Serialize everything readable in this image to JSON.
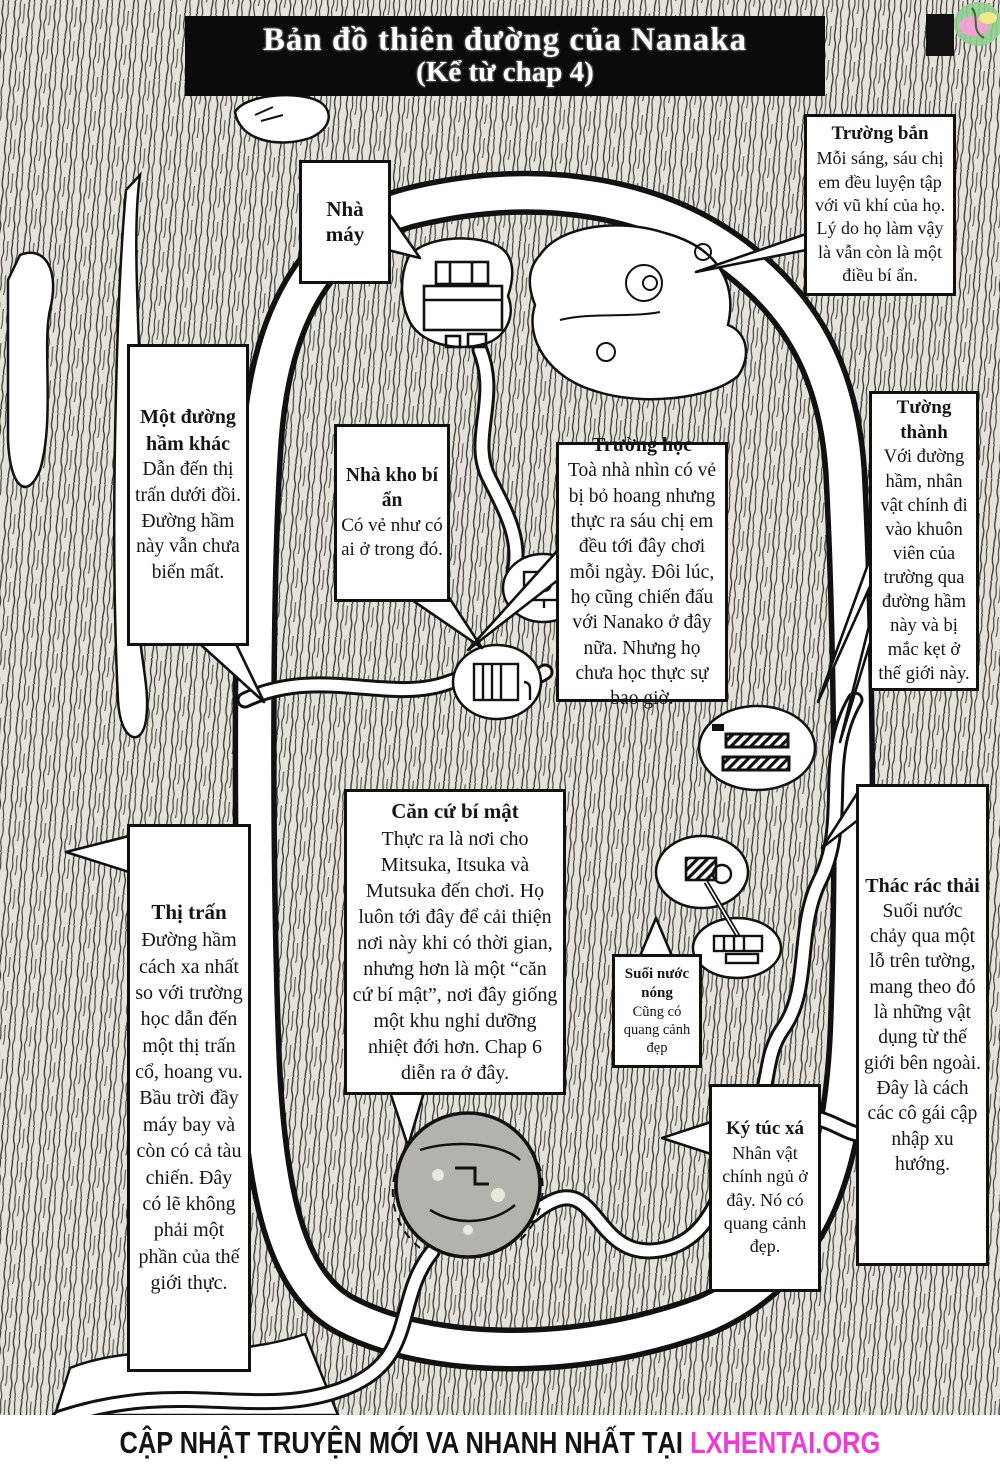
{
  "page": {
    "title_line1": "Bản đồ thiên đường của Nanaka",
    "title_line2": "(Kể từ chap 4)"
  },
  "boxes": {
    "nha_may": {
      "title": "Nhà máy"
    },
    "truong_ban": {
      "title": "Trường bắn",
      "body": "Mỗi sáng, sáu chị em đều luyện tập với vũ khí của họ. Lý do họ làm vậy là vẫn còn là một điều bí ẩn."
    },
    "duong_ham": {
      "title": "Một đường hầm khác",
      "body": "Dẫn đến thị trấn dưới đồi. Đường hầm này vẫn chưa biến mất."
    },
    "nha_kho": {
      "title": "Nhà kho bí ẩn",
      "body": "Có vẻ như có ai ở trong đó."
    },
    "truong_hoc": {
      "title": "Trường học",
      "body": "Toà nhà nhìn có vẻ bị bỏ hoang nhưng thực ra sáu chị em đều tới đây chơi mỗi ngày. Đôi lúc, họ cũng chiến đấu với Nanako ở đây nữa. Nhưng họ chưa học thực sự bao giờ."
    },
    "tuong_thanh": {
      "title": "Tường thành",
      "body": "Với đường hầm, nhân vật chính đi vào khuôn viên của trường qua đường hầm này và bị mắc kẹt ở thế giới này."
    },
    "thi_tran": {
      "title": "Thị trấn",
      "body": "Đường hầm cách xa nhất so với trường học dẫn đến một thị trấn cổ, hoang vu. Bầu trời đầy máy bay và còn có cả tàu chiến. Đây có lẽ không phải một phần của thế giới thực."
    },
    "can_cu": {
      "title": "Căn cứ bí mật",
      "body": "Thực ra là nơi cho Mitsuka, Itsuka và Mutsuka đến chơi. Họ luôn tới đây để cải thiện nơi này khi có thời gian, nhưng hơn là một “căn cứ bí mật”, nơi đây giống một khu nghỉ dưỡng nhiệt đới hơn. Chap 6 diễn ra ở đây."
    },
    "suoi": {
      "title": "Suối nước nóng",
      "body": "Cũng có quang cảnh đẹp"
    },
    "thac": {
      "title": "Thác rác thải",
      "body": "Suối nước chảy qua một lỗ trên tường, mang theo đó là những vật dụng từ thế giới bên ngoài. Đây là cách các cô gái cập nhập xu hướng."
    },
    "ky_tuc": {
      "title": "Ký túc xá",
      "body": "Nhân vật chính ngủ ở đây. Nó có quang cảnh đẹp."
    }
  },
  "footer": {
    "text": "CẬP NHẬT TRUYỆN MỚI VA NHANH NHẤT TẠI",
    "site": "LXHENTAI.ORG",
    "site_color": "#ee3bd6"
  }
}
